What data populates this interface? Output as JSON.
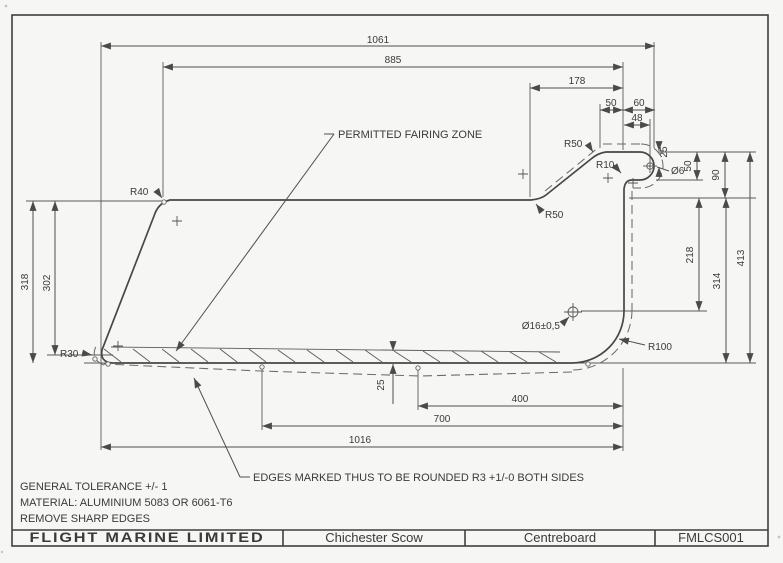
{
  "colors": {
    "paper": "#f6f6f4",
    "line": "#474747",
    "text": "#3a3a3a"
  },
  "title_block": {
    "company": "FLIGHT MARINE LIMITED",
    "boat": "Chichester Scow",
    "part": "Centreboard",
    "drawing_number": "FMLCS001"
  },
  "notes": {
    "line1": "GENERAL TOLERANCE +/- 1",
    "line2": "MATERIAL:  ALUMINIUM 5083 OR 6061-T6",
    "line3": "REMOVE SHARP EDGES"
  },
  "annotations": {
    "fairing_zone": "PERMITTED FAIRING ZONE",
    "edge_note": "EDGES MARKED THUS TO BE ROUNDED R3 +1/-0 BOTH SIDES"
  },
  "dims": {
    "overall_length": "1061",
    "top_edge_length": "885",
    "head_setback": "178",
    "head_top_50": "50",
    "head_top_60": "60",
    "head_top_48": "48",
    "head_hole_offset": "25",
    "head_thickness": "50",
    "head_to_top_edge": "90",
    "top_edge_to_hole": "218",
    "top_to_bottom_right": "314",
    "overall_depth": "413",
    "left_depth": "318",
    "left_tip_depth": "302",
    "fairing_thickness": "25",
    "bottom_400": "400",
    "bottom_700": "700",
    "bottom_1016": "1016"
  },
  "radii": {
    "r40": "R40",
    "r30": "R30",
    "r50_top": "R50",
    "r50_bottom": "R50",
    "r10": "R10",
    "r100": "R100"
  },
  "holes": {
    "head_hole": "Ø6",
    "pivot_hole": "Ø16±0,5"
  }
}
